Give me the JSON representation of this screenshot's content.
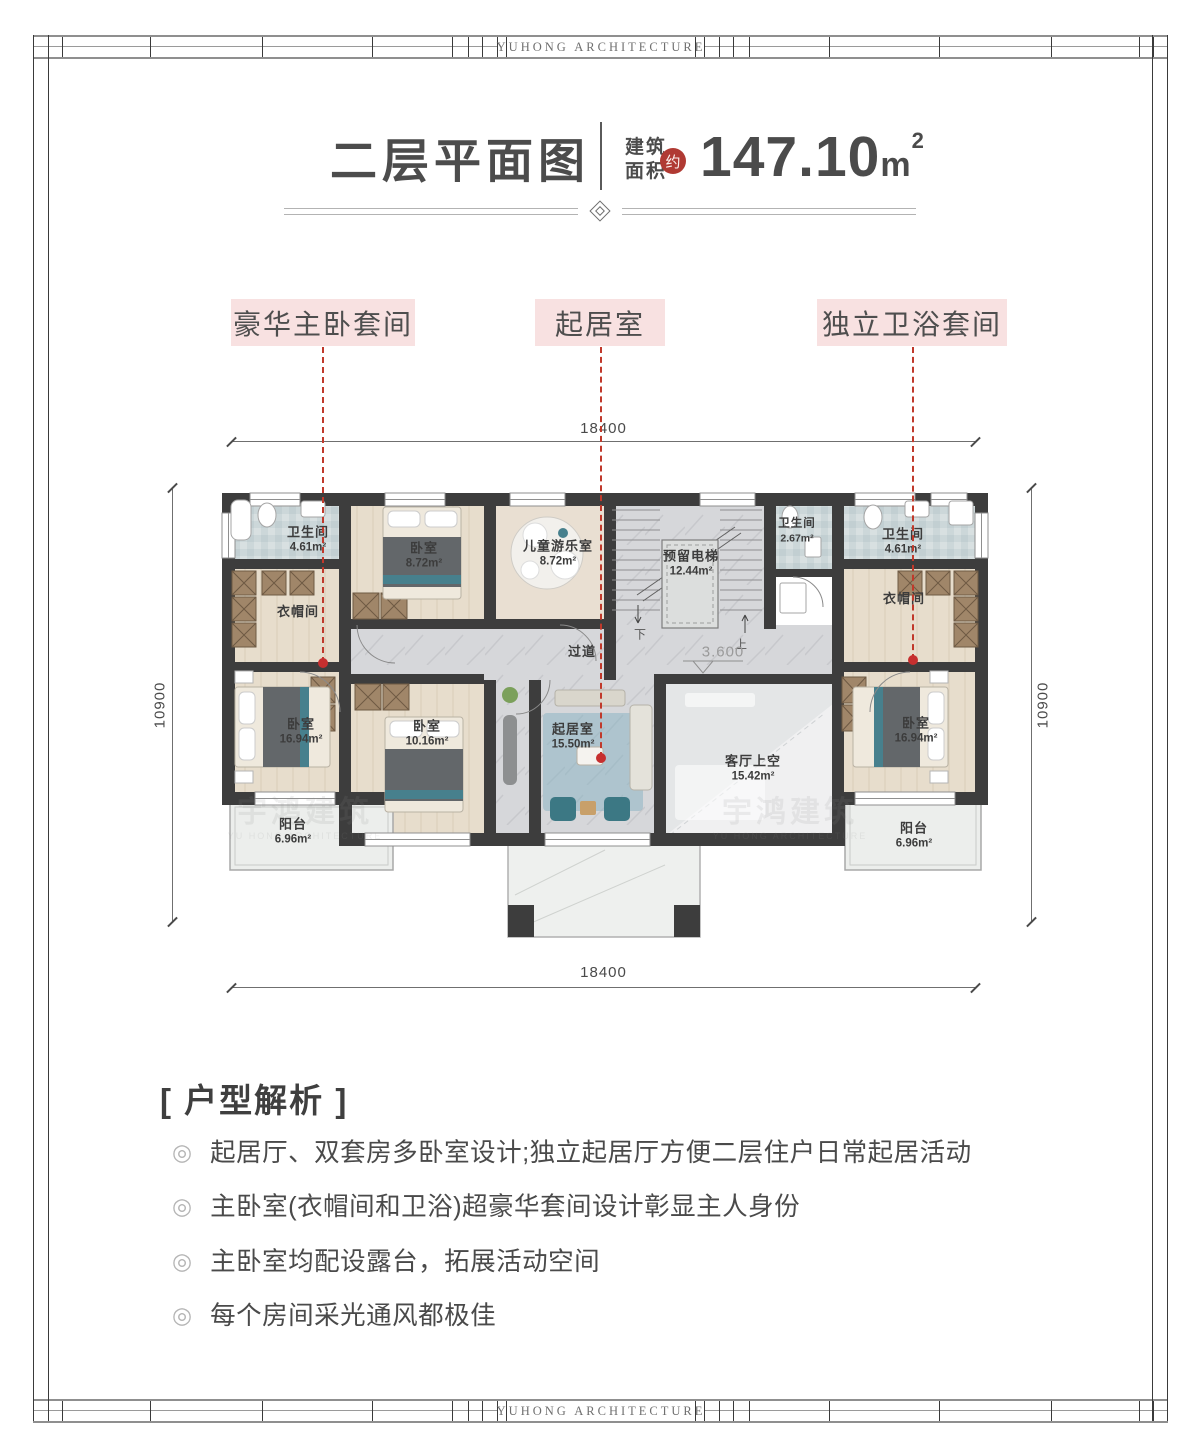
{
  "frame": {
    "brand": "YUHONG    ARCHITECTURE"
  },
  "header": {
    "title": "二层平面图",
    "area_label_line1": "建筑",
    "area_label_line2": "面积",
    "approx_badge": "约",
    "area_value": "147.10",
    "area_unit_base": "m",
    "area_unit_sup": "2"
  },
  "callouts": [
    {
      "label": "豪华主卧套间"
    },
    {
      "label": "起居室"
    },
    {
      "label": "独立卫浴套间"
    }
  ],
  "dimensions": {
    "top": "18400",
    "bottom": "18400",
    "left": "10900",
    "right": "10900",
    "level": "3.600",
    "stair_down": "下",
    "stair_up": "上"
  },
  "plan": {
    "watermark": {
      "text": "宇鸿建筑",
      "subtext": "YU HONG ARCHITECTURE"
    },
    "rooms": [
      {
        "name": "卫生间",
        "area": "4.61m²"
      },
      {
        "name": "卧室",
        "area": "8.72m²"
      },
      {
        "name": "儿童游乐室",
        "area": "8.72m²"
      },
      {
        "name": "预留电梯",
        "area": "12.44m²"
      },
      {
        "name": "卫生间",
        "area": "2.67m²"
      },
      {
        "name": "卫生间",
        "area": "4.61m²"
      },
      {
        "name": "衣帽间",
        "area": ""
      },
      {
        "name": "衣帽间",
        "area": ""
      },
      {
        "name": "过道",
        "area": ""
      },
      {
        "name": "卧室",
        "area": "16.94m²"
      },
      {
        "name": "卧室",
        "area": "10.16m²"
      },
      {
        "name": "起居室",
        "area": "15.50m²"
      },
      {
        "name": "客厅上空",
        "area": "15.42m²"
      },
      {
        "name": "卧室",
        "area": "16.94m²"
      },
      {
        "name": "阳台",
        "area": "6.96m²"
      },
      {
        "name": "阳台",
        "area": "6.96m²"
      }
    ]
  },
  "analysis": {
    "title": "[ 户型解析 ]",
    "bullet_icon": "◎",
    "items": [
      "起居厅、双套房多卧室设计;独立起居厅方便二层住户日常起居活动",
      "主卧室(衣帽间和卫浴)超豪华套间设计彰显主人身份",
      "主卧室均配设露台，拓展活动空间",
      "每个房间采光通风都极佳"
    ]
  },
  "colors": {
    "accent_red": "#b03a33",
    "callout_pink": "#f8e1e1",
    "leader_red": "#c0392b",
    "wall": "#3d3d3d"
  }
}
